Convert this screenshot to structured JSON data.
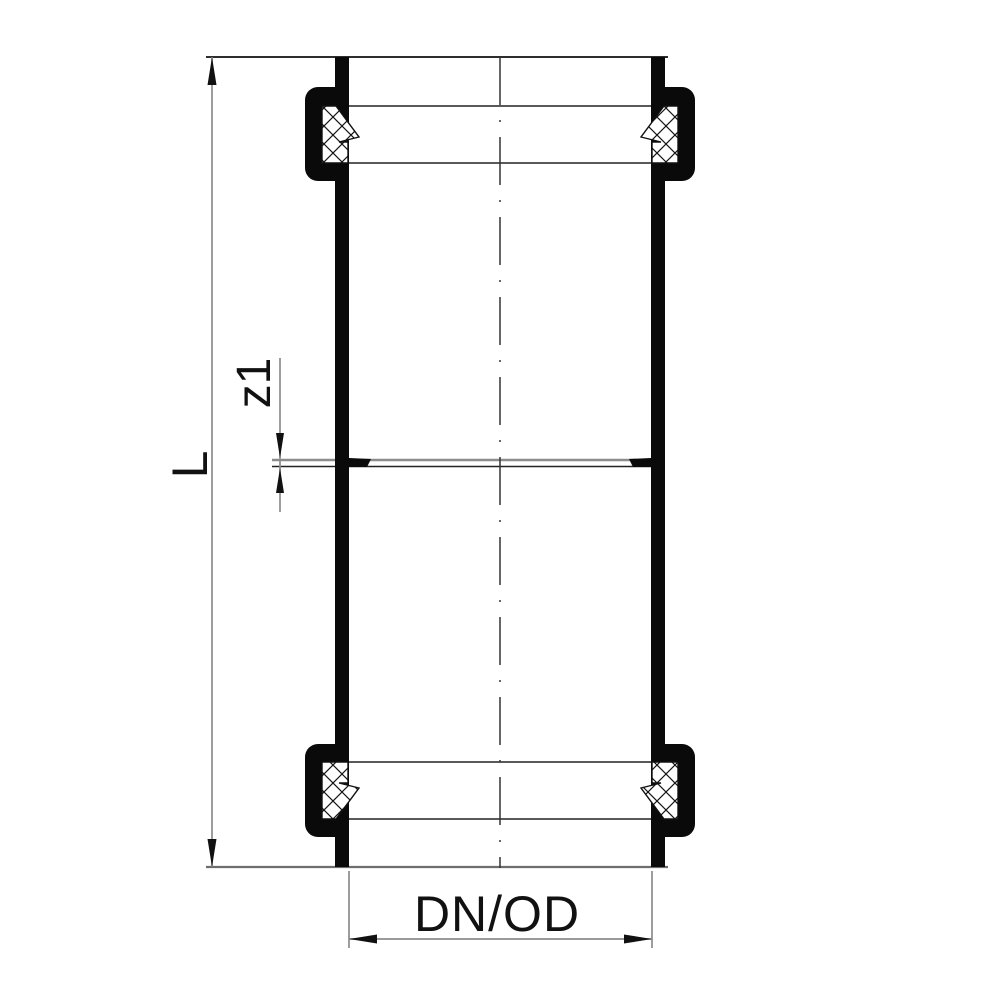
{
  "drawing": {
    "description": "Cross-section engineering drawing of a double-socket pipe coupling (repair sleeve) with two sealing rings",
    "dimensions": {
      "overall_length": "L",
      "mid_stop_gap": "z1",
      "nominal_diameter": "DN/OD"
    },
    "colors": {
      "object_line": "#1a1a1a",
      "solid_fill": "#0a0a0a",
      "dimension_line": "#8c8c8c",
      "background": "#ffffff"
    }
  }
}
